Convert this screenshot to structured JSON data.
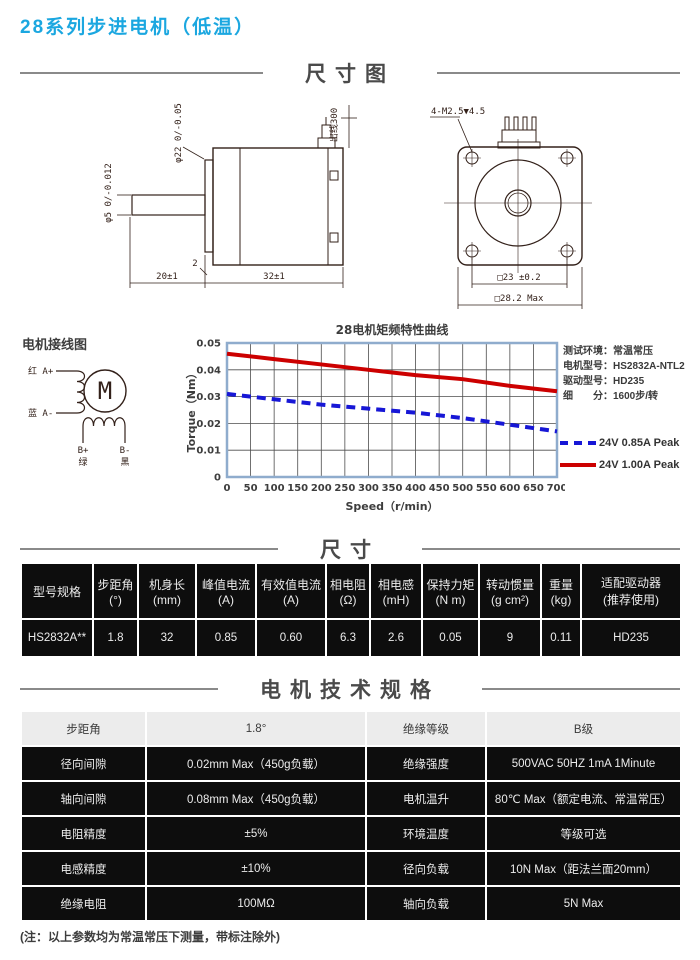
{
  "page": {
    "title": "28系列步进电机（低温）",
    "footnote": "(注：以上参数均为常温常压下测量，带标注除外)"
  },
  "sections": {
    "drawing": "尺寸图",
    "size": "尺寸",
    "specs": "电机技术规格"
  },
  "side_view": {
    "dim_shaft_dia": "φ5 0/-0.012",
    "dim_pilot_dia": "φ22 0/-0.05",
    "dim_wire": "出线300",
    "dim_shaft_len": "20±1",
    "dim_body_len": "32±1",
    "dim_pilot_depth": "2"
  },
  "front_view": {
    "dim_screws": "4-M2.5▼4.5",
    "dim_pitch": "□23 ±0.2",
    "dim_width": "□28.2 Max"
  },
  "wiring": {
    "title": "电机接线图",
    "motor_symbol": "M",
    "a_plus": "红 A+",
    "a_minus": "蓝 A-",
    "b_plus": "B+",
    "b_minus": "B-",
    "b_plus_color": "绿",
    "b_minus_color": "黑"
  },
  "test_info": [
    {
      "label": "测试环境：",
      "value": "常温常压"
    },
    {
      "label": "电机型号：",
      "value": "HS2832A-NTL2"
    },
    {
      "label": "驱动型号：",
      "value": "HD235"
    },
    {
      "label": "细　　分：",
      "value": "1600步/转"
    }
  ],
  "chart_data": {
    "type": "line",
    "title": "28电机矩频特性曲线",
    "xlabel": "Speed（r/min）",
    "ylabel": "Torque（Nm）",
    "xlim": [
      0,
      700
    ],
    "ylim": [
      0,
      0.05
    ],
    "xticks": [
      0,
      50,
      100,
      150,
      200,
      250,
      300,
      350,
      400,
      450,
      500,
      550,
      600,
      650,
      700
    ],
    "yticks": [
      0,
      0.01,
      0.02,
      0.03,
      0.04,
      0.05
    ],
    "grid": true,
    "legend_position": "right",
    "x": [
      0,
      100,
      200,
      300,
      400,
      500,
      600,
      700
    ],
    "series": [
      {
        "name": "24V 0.85A Peak",
        "color": "#1717d6",
        "style": "dashed",
        "values": [
          0.031,
          0.029,
          0.027,
          0.0255,
          0.024,
          0.022,
          0.0195,
          0.017
        ]
      },
      {
        "name": "24V 1.00A Peak",
        "color": "#cc0000",
        "style": "solid",
        "values": [
          0.046,
          0.044,
          0.042,
          0.04,
          0.038,
          0.0365,
          0.034,
          0.032
        ]
      }
    ]
  },
  "spec_table": {
    "headers": [
      "型号规格",
      "步距角\n(°)",
      "机身长\n(mm)",
      "峰值电流\n(A)",
      "有效值电流\n(A)",
      "相电阻\n(Ω)",
      "相电感\n(mH)",
      "保持力矩\n(N m)",
      "转动惯量\n(g cm²)",
      "重量\n(kg)",
      "适配驱动器\n(推荐使用)"
    ],
    "rows": [
      [
        "HS2832A**",
        "1.8",
        "32",
        "0.85",
        "0.60",
        "6.3",
        "2.6",
        "0.05",
        "9",
        "0.11",
        "HD235"
      ]
    ]
  },
  "tech_table": {
    "rows": [
      [
        "步距角",
        "1.8°",
        "绝缘等级",
        "B级"
      ],
      [
        "径向间隙",
        "0.02mm Max（450g负载）",
        "绝缘强度",
        "500VAC 50HZ 1mA 1Minute"
      ],
      [
        "轴向间隙",
        "0.08mm Max（450g负载）",
        "电机温升",
        "80℃ Max（额定电流、常温常压）"
      ],
      [
        "电阻精度",
        "±5%",
        "环境温度",
        "等级可选"
      ],
      [
        "电感精度",
        "±10%",
        "径向负载",
        "10N Max（距法兰面20mm）"
      ],
      [
        "绝缘电阻",
        "100MΩ",
        "轴向负载",
        "5N  Max"
      ]
    ]
  },
  "colors": {
    "accent": "#1ba7e0",
    "chart_border": "#8faccd",
    "grid_line": "#4d4d4d",
    "table_bg": "#0d0d0d"
  }
}
